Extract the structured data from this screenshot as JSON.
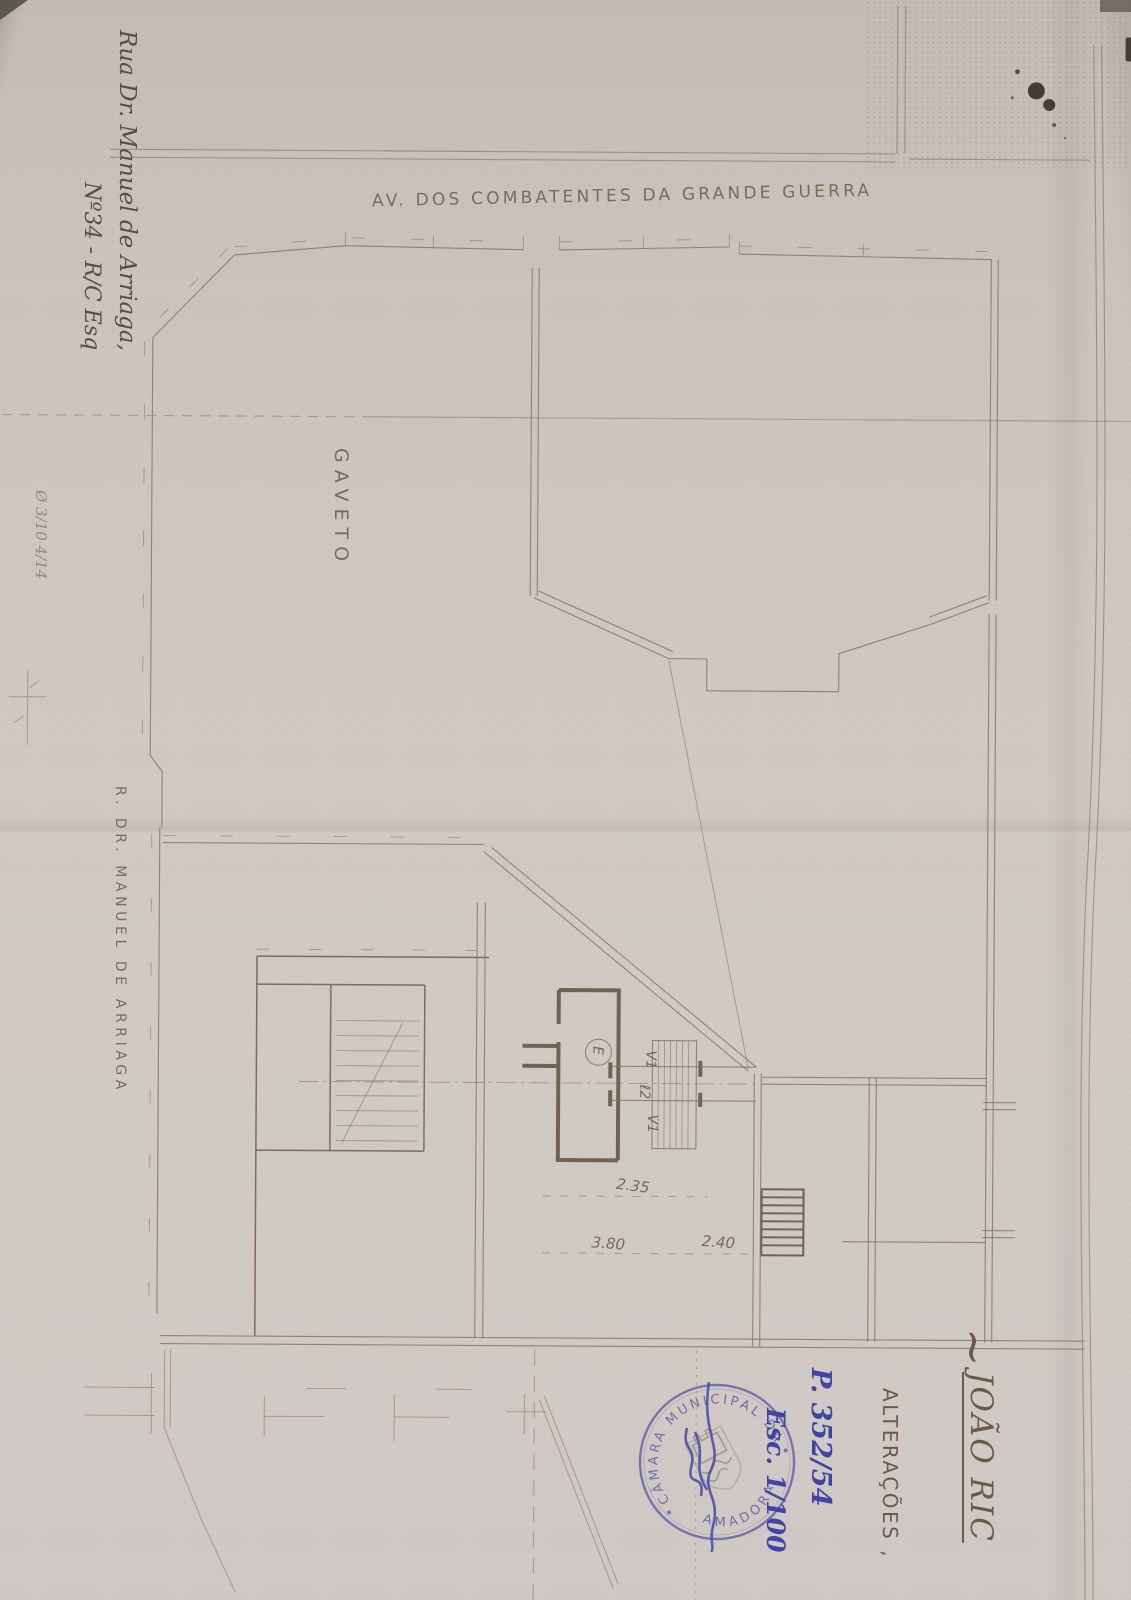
{
  "plan": {
    "street_top_label": "AV. DOS COMBATENTES DA GRANDE GUERRA",
    "corner_label": "GAVETO",
    "street_left_label": "R. DR. MANUEL DE ARRIAGA",
    "dim_235": "2.35",
    "dim_380": "3.80",
    "dim_240": "2.40",
    "label_v1_top": "V1",
    "label_l2": "ℓ2",
    "label_v1_bottom": "V1",
    "label_e": "E"
  },
  "annotations": {
    "address_line1": "Rua Dr. Manuel de Arriaga,",
    "address_line2": "Nº34 - R/C Esq",
    "pencil_note": "Ø 3/10 4/14",
    "blue_process_no": "P. 352/54",
    "blue_scale": "Esc. 1/100"
  },
  "title_block": {
    "tilde": "~",
    "owner_name": "JOÃO RIC",
    "subtitle": "ALTERAÇÕES ,"
  },
  "stamp": {
    "arc_top": "CÂMARA MUNICIPAL DA",
    "arc_bottom": "AMADORA",
    "ink_color": "#5b5ea6"
  }
}
